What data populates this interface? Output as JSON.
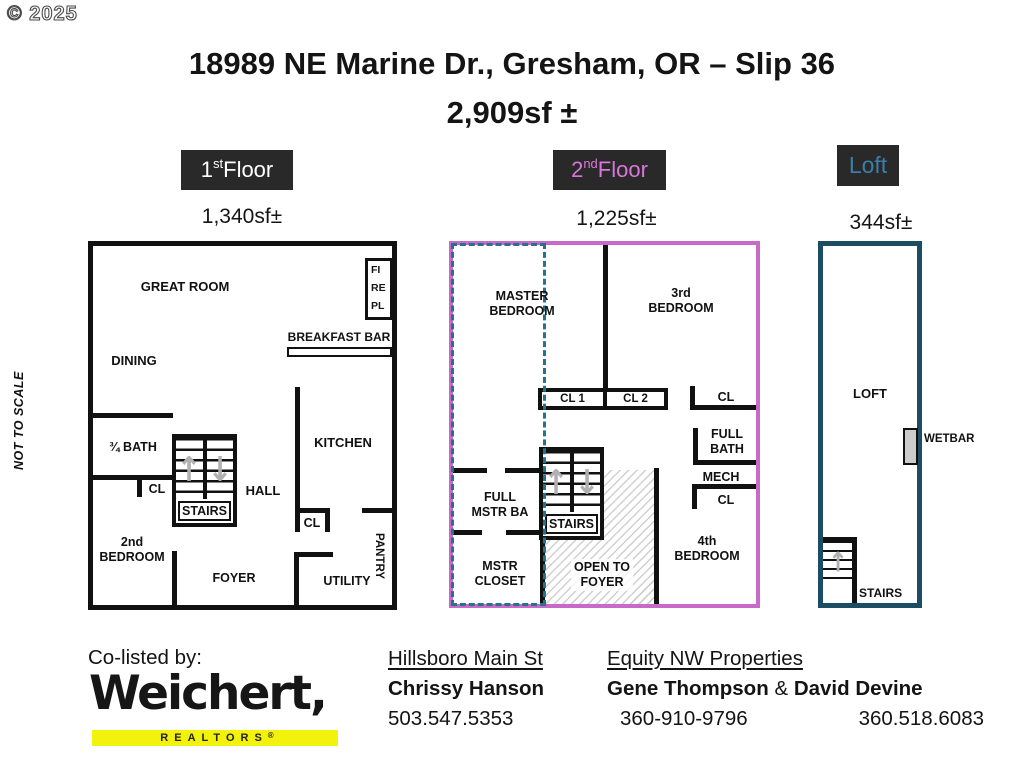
{
  "watermark": "© 2025",
  "scale_note": "NOT TO SCALE",
  "title": {
    "line1": "18989 NE Marine Dr., Gresham, OR – Slip 36",
    "line2": "2,909sf ±"
  },
  "colors": {
    "tab_bg": "#292929",
    "floor2_outline": "#c76bc7",
    "floor2_text": "#d877d8",
    "loft_outline": "#1d4d63",
    "loft_text": "#3b7fa8",
    "loft_dash": "#27718f",
    "realtors_yellow": "#f2f20c",
    "arrow_gray": "#b0b0b0"
  },
  "tabs": {
    "first": {
      "num": "1",
      "sup": "st",
      "rest": " Floor",
      "area": "1,340sf±"
    },
    "second": {
      "num": "2",
      "sup": "nd",
      "rest": " Floor",
      "area": "1,225sf±"
    },
    "loft": {
      "label": "Loft",
      "area": "344sf±"
    }
  },
  "icons": {
    "up_arrow": "↑",
    "down_arrow": "↓"
  },
  "plan1": {
    "great_room": "GREAT ROOM",
    "fireplace": {
      "l1": "FI",
      "l2": "RE",
      "l3": "PL"
    },
    "breakfast_bar": "BREAKFAST BAR",
    "dining": "DINING",
    "bath": "¾ BATH",
    "closet": "CL",
    "stairs": "STAIRS",
    "hall": "HALL",
    "kitchen": "KITCHEN",
    "kitchen_closet": "CL",
    "pantry": "PANTRY",
    "bedroom2": {
      "l1": "2nd",
      "l2": "BEDROOM"
    },
    "foyer": "FOYER",
    "utility": "UTILITY"
  },
  "plan2": {
    "master": {
      "l1": "MASTER",
      "l2": "BEDROOM"
    },
    "bedroom3": {
      "l1": "3rd",
      "l2": "BEDROOM"
    },
    "cl1": "CL 1",
    "cl2": "CL 2",
    "cl_right": "CL",
    "full_bath": {
      "l1": "FULL",
      "l2": "BATH"
    },
    "mech": "MECH",
    "cl_small": "CL",
    "bedroom4": {
      "l1": "4th",
      "l2": "BEDROOM"
    },
    "stairs": "STAIRS",
    "open_foyer": {
      "l1": "OPEN TO",
      "l2": "FOYER"
    },
    "master_bath": {
      "l1": "FULL",
      "l2": "MSTR BA"
    },
    "master_closet": {
      "l1": "MSTR",
      "l2": "CLOSET"
    }
  },
  "plan3": {
    "loft": "LOFT",
    "wetbar": "WETBAR",
    "stairs": "STAIRS"
  },
  "footer": {
    "co_listed": "Co-listed by:",
    "brand": "Weichert,",
    "brand_sub": "REALTORS",
    "brand_reg": "®",
    "office1": "Hillsboro Main St",
    "agent1": "Chrissy Hanson",
    "phone1": "503.547.5353",
    "office2": "Equity NW Properties",
    "agent2_name1": "Gene Thompson",
    "agent2_amp": "&",
    "agent2_name2": "David Devine",
    "phone2a": "360-910-9796",
    "phone2b": "360.518.6083"
  }
}
